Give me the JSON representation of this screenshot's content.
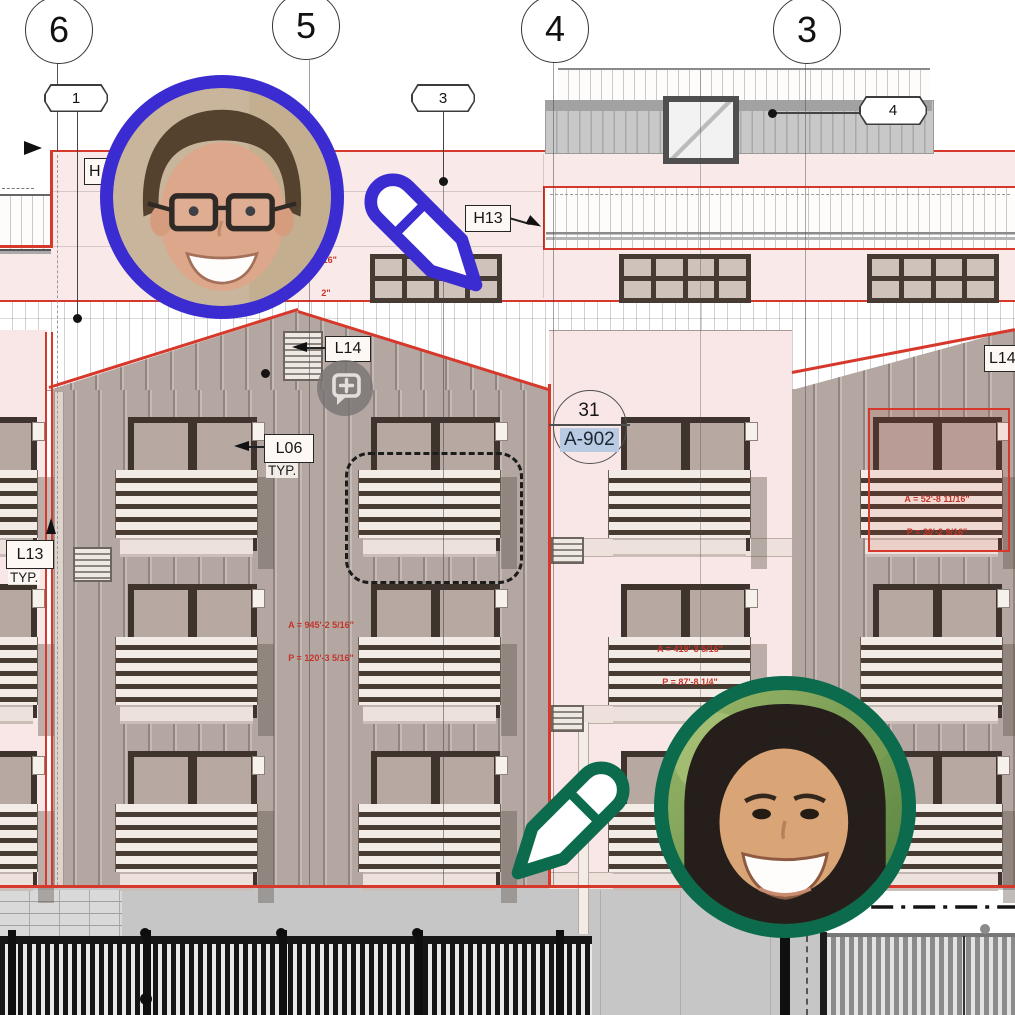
{
  "drawing": {
    "grid_bubbles": [
      "6",
      "5",
      "4",
      "3"
    ],
    "callouts": [
      "1",
      "3",
      "4"
    ],
    "tags": {
      "h13": "H13",
      "l14_gable": "L14",
      "l14_right": "L14",
      "l06": "L06",
      "l06_typ": "TYP.",
      "l13": "L13",
      "l13_typ": "TYP.",
      "h_partial": "H"
    },
    "section_marker": {
      "detail_number": "31",
      "sheet_number": "A-902"
    },
    "area_annotations": [
      {
        "area": "A = 945'-2 5/16\"",
        "perimeter": "P = 120'-3 5/16\""
      },
      {
        "area": "A = 419'-3 5/16\"",
        "perimeter": "P = 87'-8 1/4\""
      },
      {
        "area": "A = 52'-8 11/16\"",
        "perimeter": "P = 30'-2 9/16\""
      }
    ],
    "clipped_annotation_lines": [
      "5/16\"",
      "2\""
    ]
  },
  "collaboration": {
    "cursor_blue": "#3a2cd1",
    "cursor_green": "#0b6b4c",
    "comment_icon_gray": "#797575"
  },
  "colors": {
    "accent_red": "#d6382b",
    "annotation_red": "#c4352b",
    "sheet_link_highlight": "#b9cbe3",
    "wall_mauve": "#b4a7a2",
    "band_pink": "#f9e9e8"
  }
}
